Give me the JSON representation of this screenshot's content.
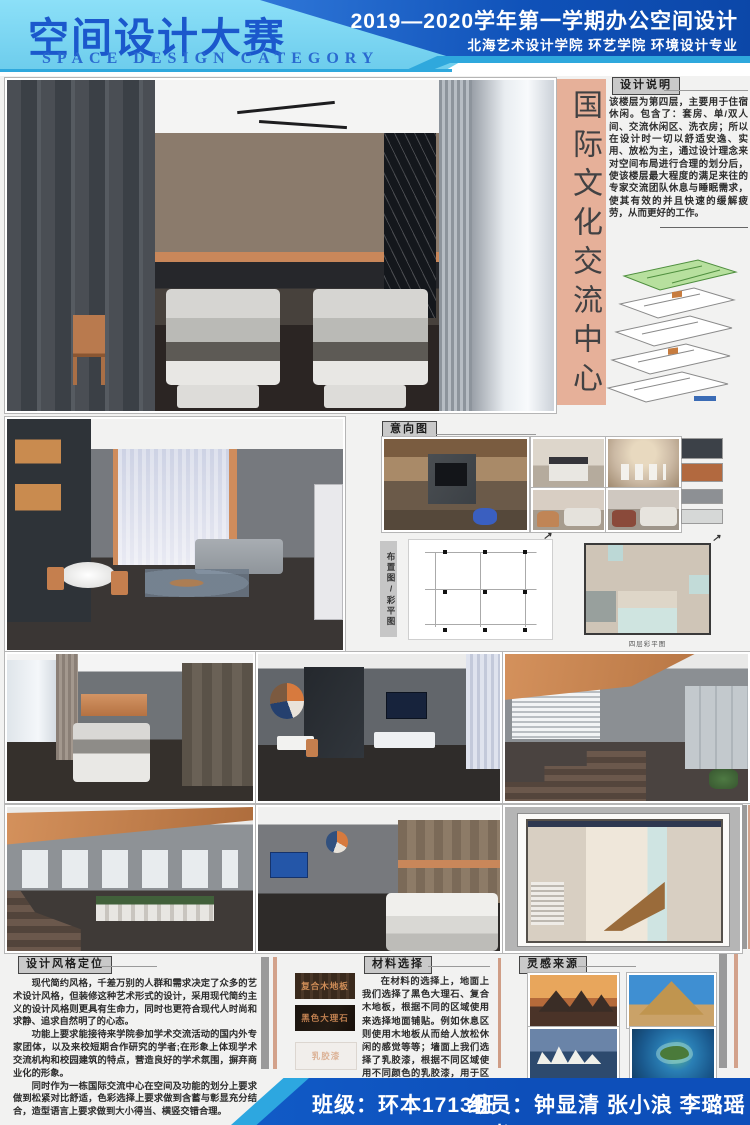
{
  "header": {
    "title": "空间设计大赛",
    "subtitle": "SPACE DESIGN CATEGORY",
    "course_line": "2019—2020学年第一学期办公空间设计",
    "dept_line": "北海艺术设计学院 环艺学院 环境设计专业"
  },
  "side": {
    "vertical_title": "国际文化交流中心"
  },
  "design_notes": {
    "label": "设计说明",
    "body": "该楼层为第四层，主要用于住宿休闲。包含了：套房、单/双人间、交流休闲区、洗衣房；所以在设计时一切以舒适安逸、实用、放松为主，通过设计理念来对空间布局进行合理的划分后，使该楼层最大程度的满足来往的专家交流团队休息与睡眠需求，使其有效的并且快速的缓解疲劳，从而更好的工作。"
  },
  "mood": {
    "label": "意向图",
    "palette": [
      "#3c4148",
      "#b2693f",
      "#8d9094",
      "#d6d8d7"
    ],
    "palette_styles": [
      "background:#3c4148",
      "background:#b2693f",
      "background:#8d9094",
      "background:#d6d8d7"
    ]
  },
  "plans": {
    "label": "布置图/彩平图",
    "caption": "四层彩平图",
    "north_icon": "↗"
  },
  "style_section": {
    "label": "设计风格定位",
    "paragraphs": [
      "现代简约风格，千差万别的人群和需求决定了众多的艺术设计风格，但装修这种艺术形式的设计，采用现代简约主义的设计风格则更具有生命力，同时也更符合现代人时尚和求静、追求自然明了的心态。",
      "功能上要求能接待来学院参加学术交流活动的国内外专家团体，以及来校短期合作研究的学者;在形象上体现学术交流机构和校园建筑的特点，营造良好的学术氛围，摒弃商业化的形象。",
      "同时作为一栋国际交流中心在空间及功能的划分上要求做到松紧对比舒适，色彩选择上要求做到含蓄与彰显充分结合，造型语言上要求做到大小得当、横竖交错合理。"
    ]
  },
  "materials": {
    "label": "材料选择",
    "swatches": [
      "复合木地板",
      "黑色大理石",
      "乳胶漆"
    ],
    "body": "在材料的选择上，地面上我们选择了黑色大理石、复合木地板，根据不同的区域使用来选择地面铺贴。例如休息区则使用木地板从而给人放松休闲的感觉等等；墙面上我们选择了乳胶漆，根据不同区域使用不同颜色的乳胶漆，用于区分空间以及简单的装饰作用。"
  },
  "inspiration": {
    "label": "灵感来源"
  },
  "footer": {
    "class_line": "班级：环本1713班",
    "members_line": "组员：钟显清 张小浪 李璐瑶 石书"
  },
  "colors": {
    "header_light_blue": "#7ed9f5",
    "header_dark_blue": "#0f51b8",
    "accent_cyan": "#2fa8dd",
    "accent_orange": "#c9875a",
    "side_salmon": "#e6b099",
    "footer_blue": "#1158cc",
    "bar_gray": "#9a9a9a",
    "bar_salmon": "#d3a28b"
  }
}
